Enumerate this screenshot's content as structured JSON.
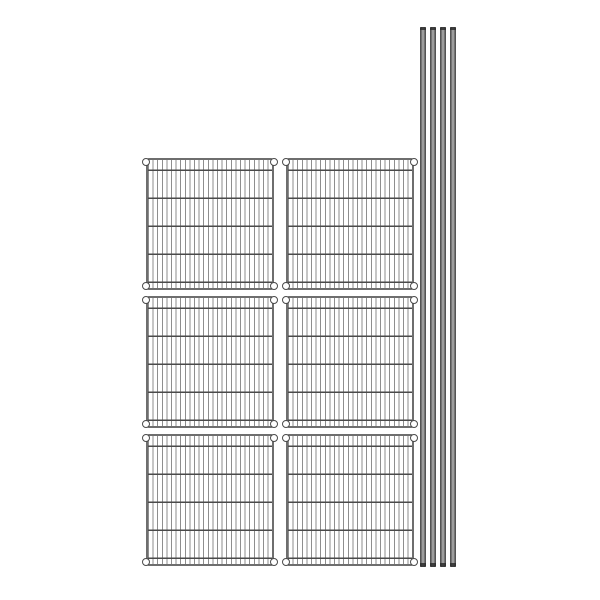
{
  "image": {
    "type": "product-illustration",
    "subject": "Wire shelving unit kit: six wire shelf panels and four posts",
    "background_color": "#ffffff"
  },
  "shelves": {
    "count": 6,
    "rows": 3,
    "columns": 2,
    "corner_collars_per_shelf": 4
  },
  "posts": {
    "count": 4
  },
  "colors": {
    "background": "#ffffff",
    "shelf-frame": "#6e6e6e",
    "shelf-wire": "#8e8e8e",
    "shelf-crossbar": "#4a4a4a",
    "collar-fill": "#ffffff",
    "collar-outline": "#4a4a4a",
    "post-edge": "#454545",
    "post-mid": "#7a7a7a",
    "post-highlight": "#b4b4b4",
    "post-cap": "#2d2d2d"
  }
}
